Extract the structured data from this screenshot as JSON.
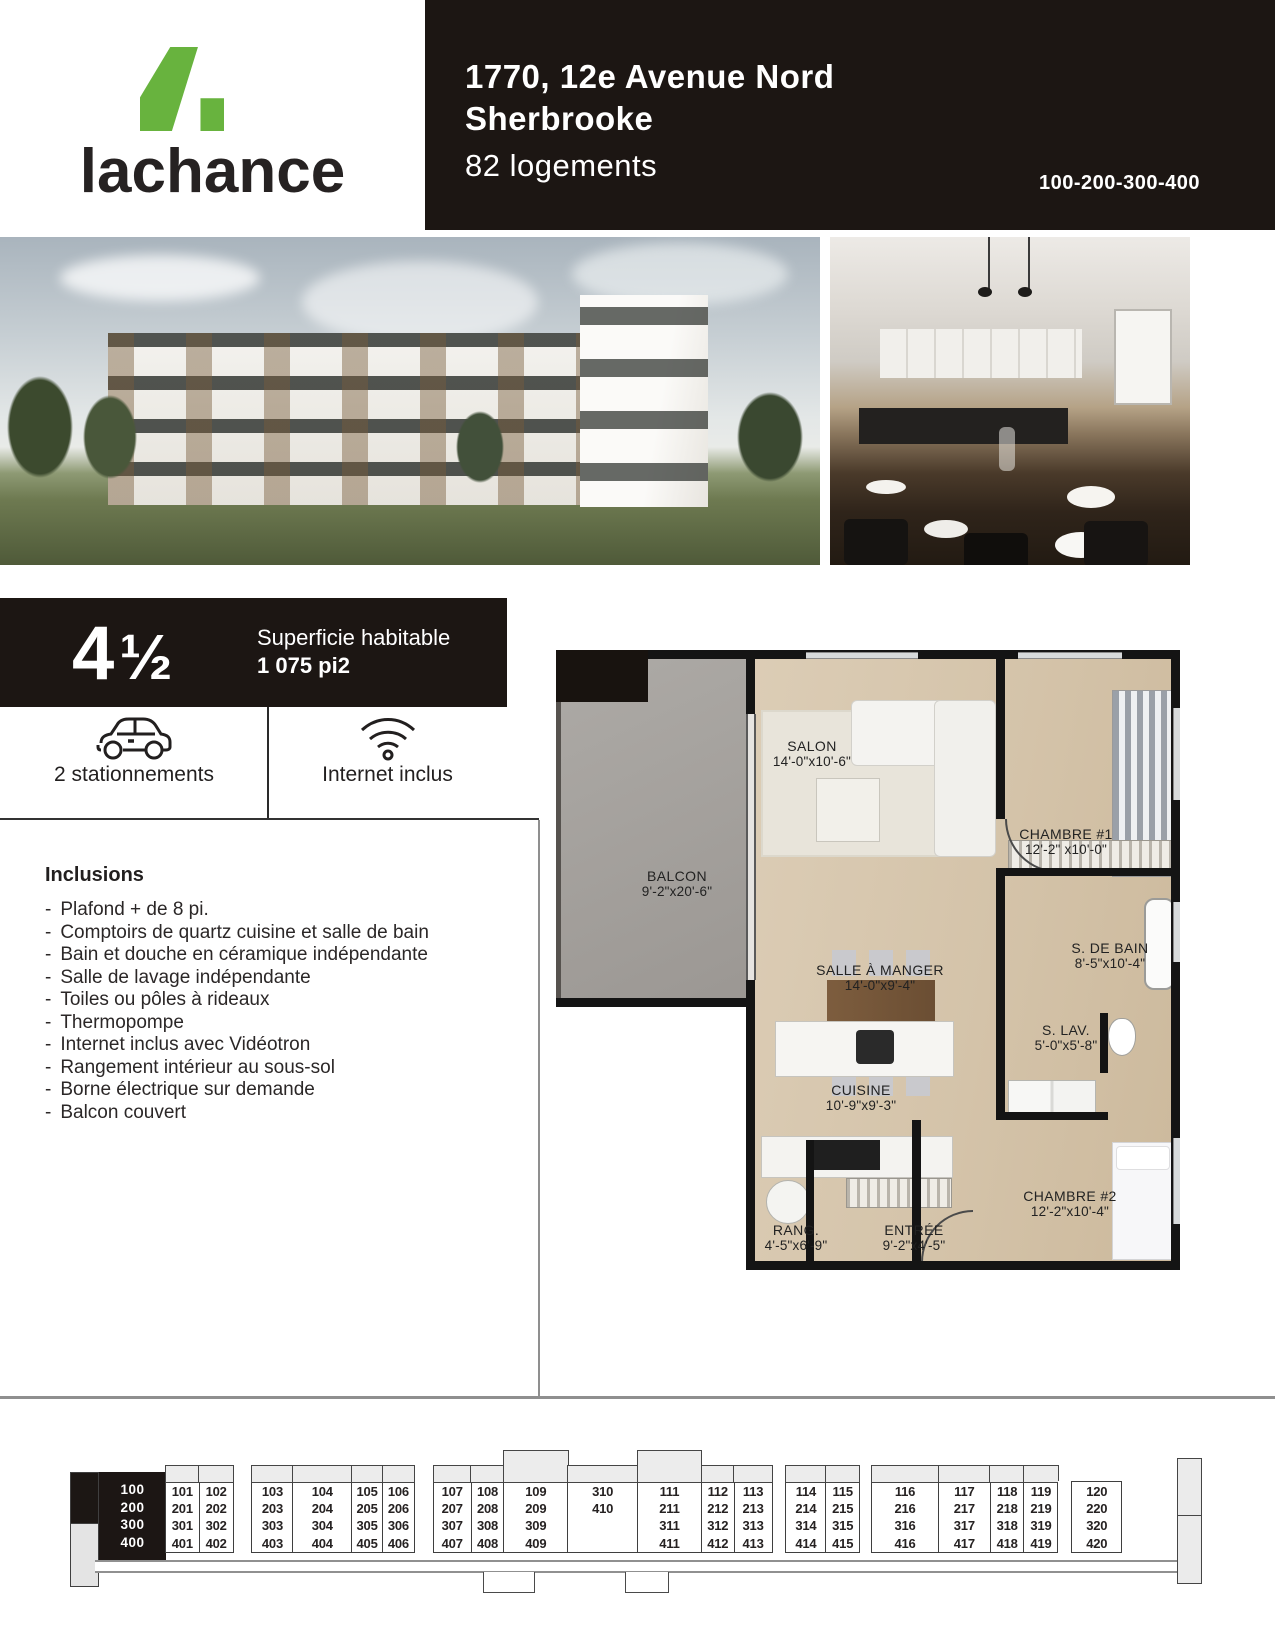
{
  "brand": {
    "name": "lachance"
  },
  "header": {
    "address_line1": "1770, 12e Avenue Nord",
    "address_line2": "Sherbrooke",
    "units": "82 logements",
    "unit_series": "100-200-300-400"
  },
  "unit_badge": {
    "type_number": "4",
    "type_fraction": "½",
    "area_label": "Superficie habitable",
    "area_value": "1 075 pi2"
  },
  "features": [
    {
      "icon": "car-icon",
      "label": "2 stationnements"
    },
    {
      "icon": "wifi-icon",
      "label": "Internet inclus"
    }
  ],
  "inclusions": {
    "title": "Inclusions",
    "items": [
      "Plafond + de 8 pi.",
      "Comptoirs de quartz cuisine et salle de bain",
      "Bain et douche en céramique indépendante",
      "Salle de lavage indépendante",
      "Toiles ou pôles à rideaux",
      "Thermopompe",
      "Internet inclus avec Vidéotron",
      "Rangement intérieur au sous-sol",
      "Borne électrique sur demande",
      "Balcon couvert"
    ]
  },
  "floorplan": {
    "rooms": {
      "balcon": {
        "name": "BALCON",
        "dims": "9'-2\"x20'-6\""
      },
      "salon": {
        "name": "SALON",
        "dims": "14'-0\"x10'-6\""
      },
      "chambre1": {
        "name": "CHAMBRE #1",
        "dims": "12'-2\" x10'-0\""
      },
      "s_de_bain": {
        "name": "S. DE BAIN",
        "dims": "8'-5\"x10'-4\""
      },
      "salle_a_manger": {
        "name": "SALLE À MANGER",
        "dims": "14'-0\"x9'-4\""
      },
      "s_lav": {
        "name": "S. LAV.",
        "dims": "5'-0\"x5'-8\""
      },
      "cuisine": {
        "name": "CUISINE",
        "dims": "10'-9\"x9'-3\""
      },
      "chambre2": {
        "name": "CHAMBRE #2",
        "dims": "12'-2\"x10'-4\""
      },
      "rang": {
        "name": "RANG.",
        "dims": "4'-5\"x6'-9\""
      },
      "entree": {
        "name": "ENTRÉE",
        "dims": "9'-2\"x4'-5\""
      }
    }
  },
  "building_diagram": {
    "legend_floors": [
      "100",
      "200",
      "300",
      "400"
    ],
    "columns": [
      {
        "units": [
          "101",
          "201",
          "301",
          "401"
        ],
        "balcony": "small",
        "w": 35
      },
      {
        "units": [
          "102",
          "202",
          "302",
          "402"
        ],
        "balcony": "small",
        "w": 35
      },
      {
        "gap": true,
        "w": 19
      },
      {
        "units": [
          "103",
          "203",
          "303",
          "403"
        ],
        "balcony": "small",
        "w": 42
      },
      {
        "units": [
          "104",
          "204",
          "304",
          "404"
        ],
        "balcony": "small",
        "w": 60
      },
      {
        "units": [
          "105",
          "205",
          "305",
          "405"
        ],
        "balcony": "small",
        "w": 32
      },
      {
        "units": [
          "106",
          "206",
          "306",
          "406"
        ],
        "balcony": "small",
        "w": 33
      },
      {
        "gap": true,
        "w": 19
      },
      {
        "units": [
          "107",
          "207",
          "307",
          "407"
        ],
        "balcony": "small",
        "w": 39
      },
      {
        "units": [
          "108",
          "208",
          "308",
          "408"
        ],
        "balcony": "small",
        "w": 34
      },
      {
        "units": [
          "109",
          "209",
          "309",
          "409"
        ],
        "balcony": "tall",
        "w": 65
      },
      {
        "units": [
          "310",
          "410"
        ],
        "balcony": "small",
        "w": 71
      },
      {
        "units": [
          "111",
          "211",
          "311",
          "411"
        ],
        "balcony": "tall",
        "w": 65
      },
      {
        "units": [
          "112",
          "212",
          "312",
          "412"
        ],
        "balcony": "small",
        "w": 34
      },
      {
        "units": [
          "113",
          "213",
          "313",
          "413"
        ],
        "balcony": "small",
        "w": 39
      },
      {
        "gap": true,
        "w": 14
      },
      {
        "units": [
          "114",
          "214",
          "314",
          "414"
        ],
        "balcony": "small",
        "w": 41
      },
      {
        "units": [
          "115",
          "215",
          "315",
          "415"
        ],
        "balcony": "small",
        "w": 35
      },
      {
        "gap": true,
        "w": 12
      },
      {
        "units": [
          "116",
          "216",
          "316",
          "416"
        ],
        "balcony": "small",
        "w": 68
      },
      {
        "units": [
          "117",
          "217",
          "317",
          "417"
        ],
        "balcony": "small",
        "w": 53
      },
      {
        "units": [
          "118",
          "218",
          "318",
          "418"
        ],
        "balcony": "small",
        "w": 35
      },
      {
        "units": [
          "119",
          "219",
          "319",
          "419"
        ],
        "balcony": "small",
        "w": 35
      },
      {
        "gap": true,
        "w": 14
      },
      {
        "units": [
          "120",
          "220",
          "320",
          "420"
        ],
        "balcony": "none",
        "w": 51
      }
    ]
  },
  "colors": {
    "ink_black": "#1c1613",
    "brand_green": "#68b33e",
    "plan_wood": "#d6c5ab"
  }
}
